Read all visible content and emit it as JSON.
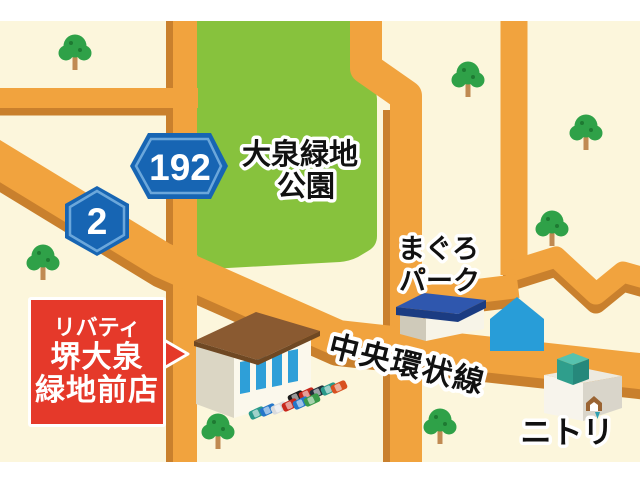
{
  "labels": {
    "park_line1": "大泉緑地",
    "park_line2": "公園",
    "maguro_line1": "まぐろ",
    "maguro_line2": "パーク",
    "ring_road": "中央環状線",
    "nitori": "ニトリ"
  },
  "badges": {
    "r192": "192",
    "r2": "2"
  },
  "callout": {
    "line1": "リバティ",
    "line2": "堺大泉",
    "line3": "緑地前店"
  },
  "colors": {
    "background_cream": "#FCF6DC",
    "margin_white": "#FFFFFF",
    "road_orange": "#F1A33E",
    "road_shadow_orange": "#C9802D",
    "park_green": "#87C23D",
    "badge_blue": "#1765B3",
    "badge_ring_blue": "#6BA7DB",
    "callout_red": "#E5392A",
    "store_roof_brown": "#8A5A31",
    "maguro_roof_blue": "#2F57AE",
    "house_blue": "#289DD8",
    "nitori_teal": "#2F9E8C",
    "tree_green": "#2FA148",
    "tree_dot_green": "#1E7A32",
    "tree_trunk": "#C08A52",
    "window_blue": "#2E9FD8",
    "label_black": "#111111",
    "label_outline": "#FFFFFF"
  },
  "trees": [
    [
      75,
      70
    ],
    [
      468,
      97
    ],
    [
      586,
      150
    ],
    [
      552,
      246
    ],
    [
      43,
      280
    ],
    [
      218,
      449
    ],
    [
      440,
      444
    ]
  ],
  "cars": [
    {
      "x": 296,
      "y": 397,
      "color": "#1B1B1B"
    },
    {
      "x": 307,
      "y": 394,
      "color": "#C8281C"
    },
    {
      "x": 318,
      "y": 392,
      "color": "#22303A"
    },
    {
      "x": 329,
      "y": 389,
      "color": "#2A9A8A"
    },
    {
      "x": 339,
      "y": 387,
      "color": "#D85020"
    },
    {
      "x": 257,
      "y": 413,
      "color": "#2A9A8A"
    },
    {
      "x": 268,
      "y": 410,
      "color": "#2476C9"
    },
    {
      "x": 279,
      "y": 408,
      "color": "#D9DBDD"
    },
    {
      "x": 290,
      "y": 405,
      "color": "#C8281C"
    },
    {
      "x": 301,
      "y": 403,
      "color": "#2476C9"
    },
    {
      "x": 312,
      "y": 400,
      "color": "#3A9A4A"
    }
  ]
}
